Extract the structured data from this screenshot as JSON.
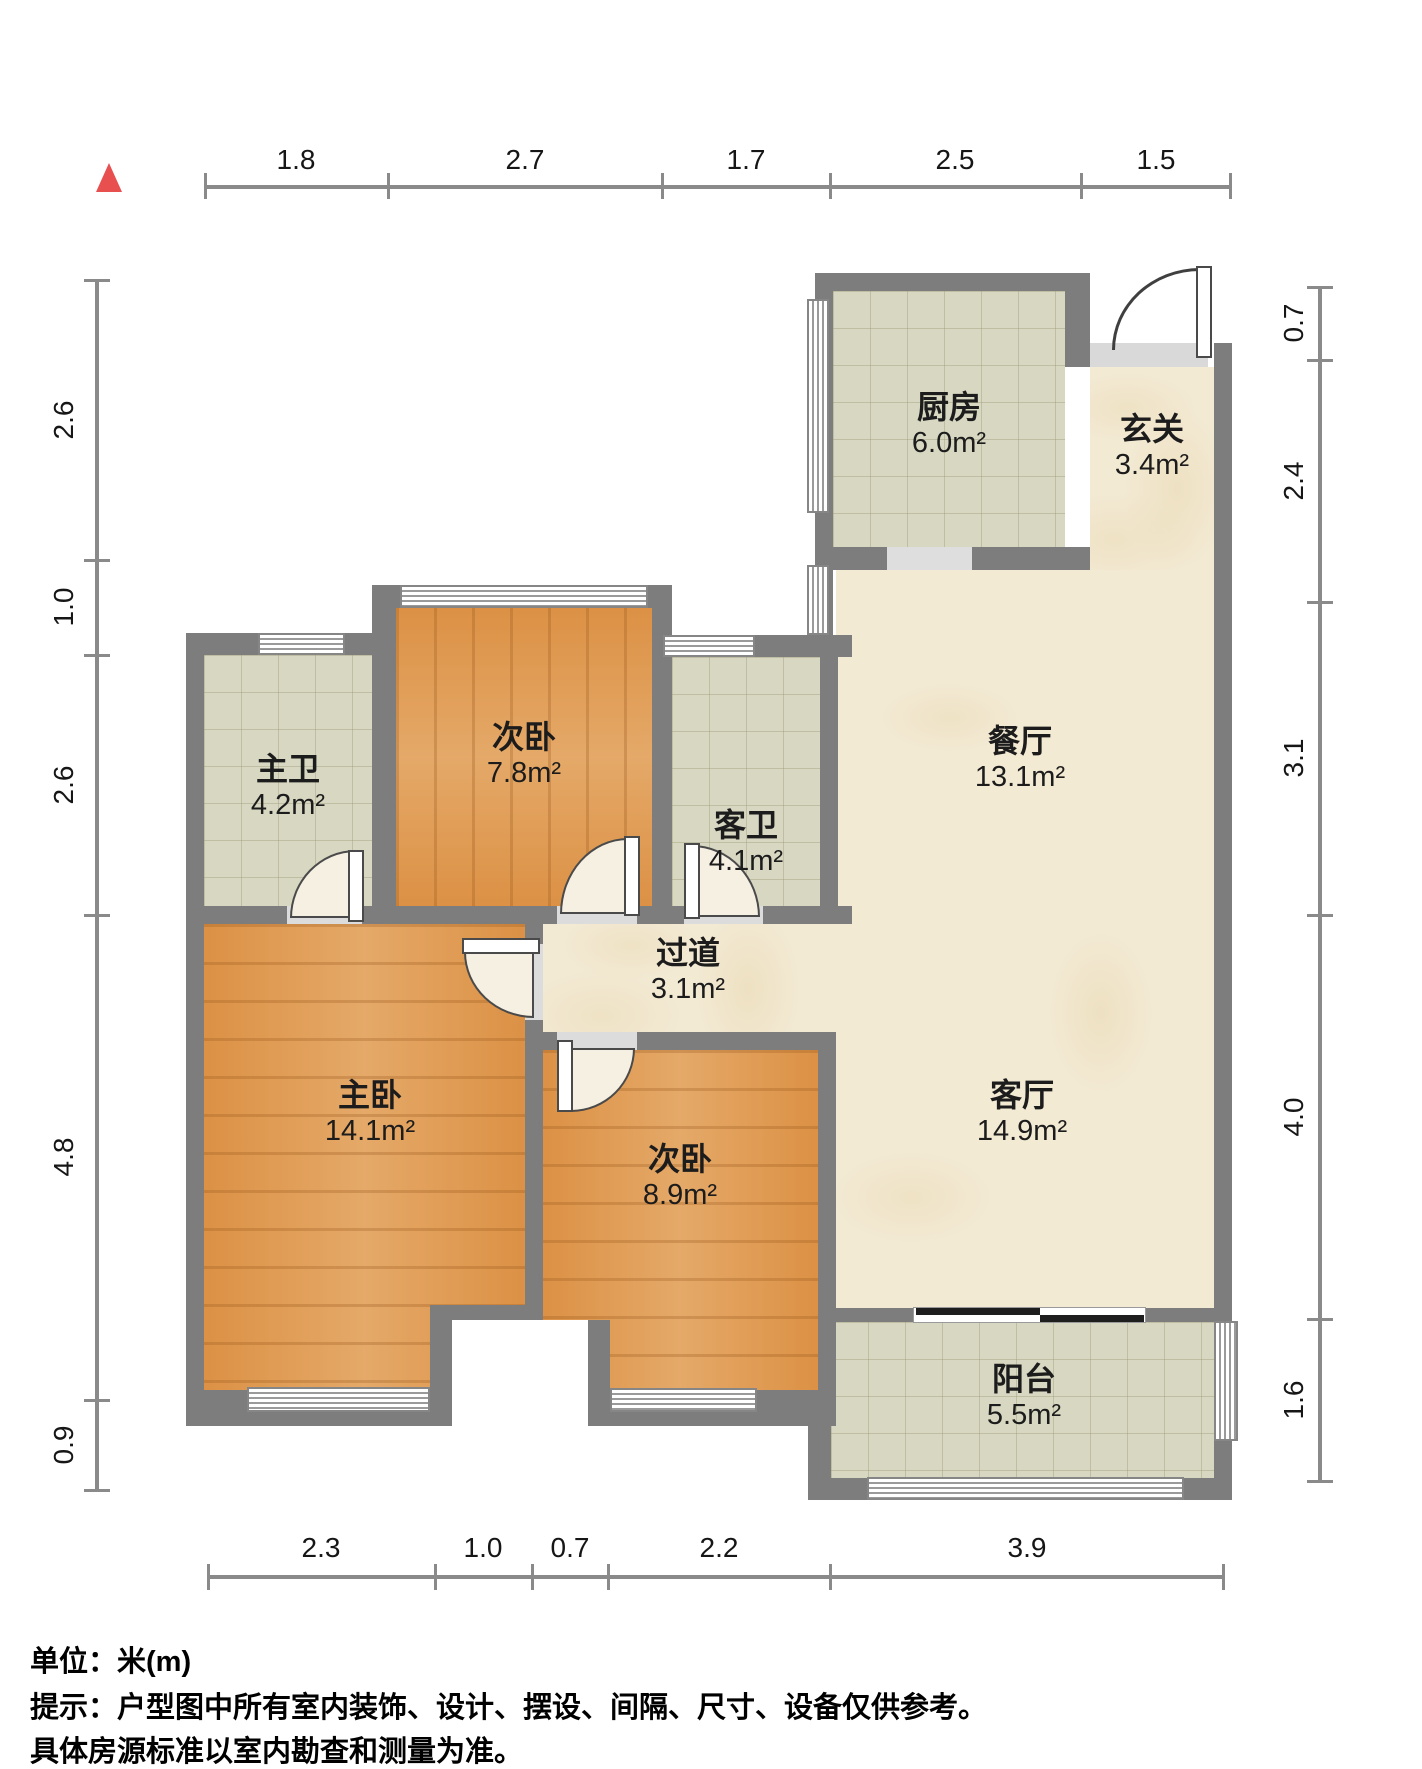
{
  "north_marker": {
    "icon": "north-triangle",
    "color": "#e85050"
  },
  "rooms": {
    "kitchen": {
      "name": "厨房",
      "area": "6.0m²"
    },
    "entry": {
      "name": "玄关",
      "area": "3.4m²"
    },
    "dining": {
      "name": "餐厅",
      "area": "13.1m²"
    },
    "living": {
      "name": "客厅",
      "area": "14.9m²"
    },
    "hallway": {
      "name": "过道",
      "area": "3.1m²"
    },
    "master_bath": {
      "name": "主卫",
      "area": "4.2m²"
    },
    "guest_bath": {
      "name": "客卫",
      "area": "4.1m²"
    },
    "bedroom_a": {
      "name": "次卧",
      "area": "7.8m²"
    },
    "bedroom_b": {
      "name": "次卧",
      "area": "8.9m²"
    },
    "master_bedroom": {
      "name": "主卧",
      "area": "14.1m²"
    },
    "balcony": {
      "name": "阳台",
      "area": "5.5m²"
    }
  },
  "dimensions": {
    "top": [
      "1.8",
      "2.7",
      "1.7",
      "2.5",
      "1.5"
    ],
    "right": [
      "0.7",
      "2.4",
      "3.1",
      "4.0",
      "1.6"
    ],
    "bottom": [
      "2.3",
      "1.0",
      "0.7",
      "2.2",
      "3.9"
    ],
    "left": [
      "2.6",
      "1.0",
      "2.6",
      "4.8",
      "0.9"
    ]
  },
  "footer": {
    "unit_line": "单位：米(m)",
    "note_line1": "提示：户型图中所有室内装饰、设计、摆设、间隔、尺寸、设备仅供参考。",
    "note_line2": "具体房源标准以室内勘查和测量为准。"
  },
  "colors": {
    "wall": "#7d7d7d",
    "wood_floor": "#dc9145",
    "tile_floor": "#d8d7c1",
    "marble_floor": "#f3ead4",
    "north_marker": "#e85050",
    "dimension_line": "#8a8a8a"
  }
}
